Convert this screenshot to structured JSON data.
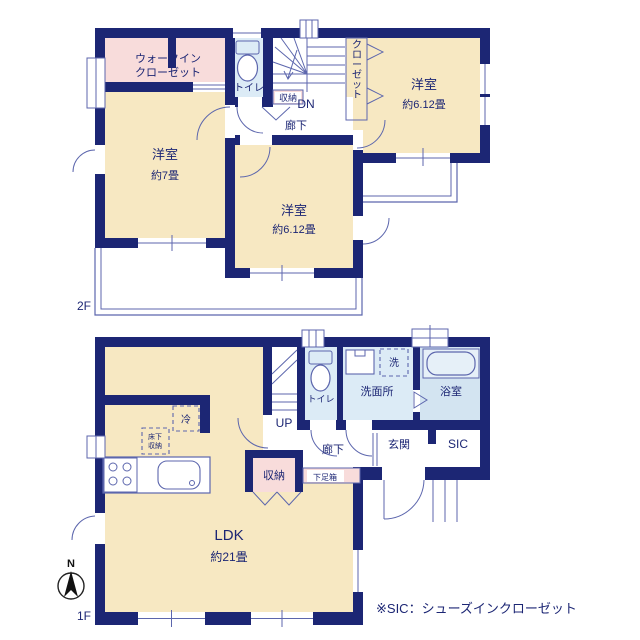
{
  "colors": {
    "wall_navy": "#1c2674",
    "room_cream": "#f7e8c2",
    "closet_pink": "#f8dcdb",
    "wet_blue": "#dcebf6",
    "bath_blue": "#d3e4f1",
    "line_indigo": "#5c66ad"
  },
  "floor2": {
    "floor_label": "2F",
    "rooms": {
      "walk_in_closet": {
        "line1": "ウォークイン",
        "line2": "クローゼット"
      },
      "toilet": "トイレ",
      "storage": "収納",
      "stairs_dir": "DN",
      "closet": "クローゼット",
      "hallway": "廊下",
      "bedroom_ne": {
        "name": "洋室",
        "size": "約6.12畳"
      },
      "bedroom_west": {
        "name": "洋室",
        "size": "約7畳"
      },
      "bedroom_center": {
        "name": "洋室",
        "size": "約6.12畳"
      }
    }
  },
  "floor1": {
    "floor_label": "1F",
    "rooms": {
      "ldk": {
        "name": "LDK",
        "size": "約21畳"
      },
      "fridge": "冷",
      "underfloor_storage": {
        "line1": "床下",
        "line2": "収納"
      },
      "stairs_dir": "UP",
      "toilet": "トイレ",
      "washroom": "洗面所",
      "washer": "洗",
      "bath": "浴室",
      "hallway": "廊下",
      "entrance": "玄関",
      "sic": "SIC",
      "storage": "収納",
      "shoe_box": "下足箱"
    }
  },
  "compass": {
    "north_label": "N"
  },
  "footnote": "※SIC：シューズインクローゼット"
}
